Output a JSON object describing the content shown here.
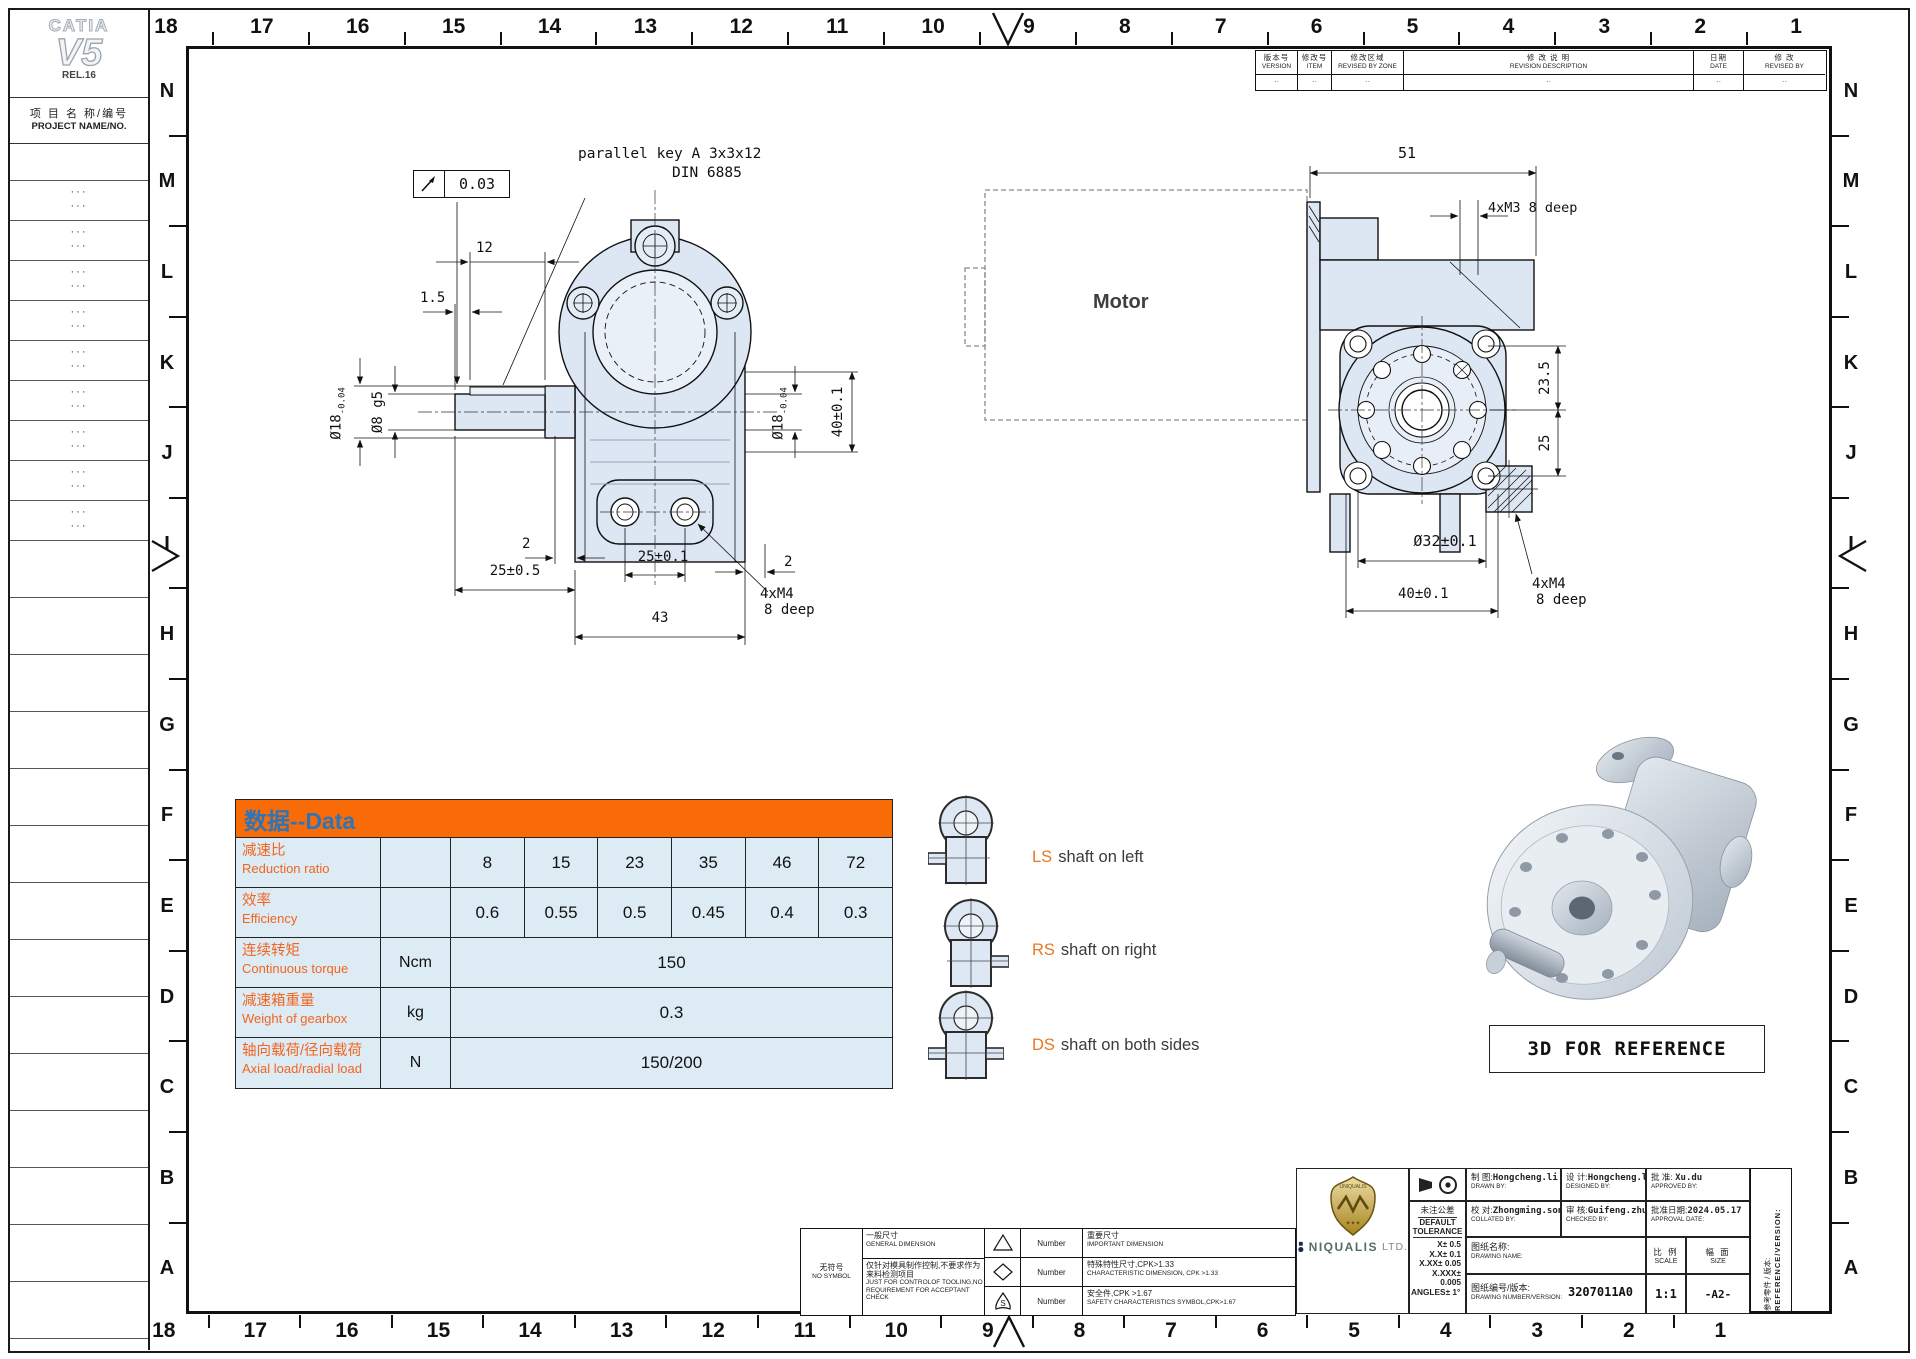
{
  "sidebar": {
    "catia": "CATIA",
    "v5": "V5",
    "rel": "REL.16",
    "project_zh": "项 目 名 称/编号",
    "project_en": "PROJECT NAME/NO.",
    "dots": "···"
  },
  "border": {
    "columns": [
      "18",
      "17",
      "16",
      "15",
      "14",
      "13",
      "12",
      "11",
      "10",
      "9",
      "8",
      "7",
      "6",
      "5",
      "4",
      "3",
      "2",
      "1"
    ],
    "rows": [
      "N",
      "M",
      "L",
      "K",
      "J",
      "I",
      "H",
      "G",
      "F",
      "E",
      "D",
      "C",
      "B",
      "A"
    ]
  },
  "revision_table": {
    "cols": [
      {
        "zh": "版本号",
        "en": "VERSION",
        "val": "··"
      },
      {
        "zh": "修改号",
        "en": "ITEM",
        "val": "··"
      },
      {
        "zh": "修改区域",
        "en": "REVISED BY ZONE",
        "val": "··"
      },
      {
        "zh": "修 改 说 明",
        "en": "REVISION DESCRIPTION",
        "val": "··"
      },
      {
        "zh": "日期",
        "en": "DATE",
        "val": "··"
      },
      {
        "zh": "修 改",
        "en": "REVISED BY",
        "val": "··"
      }
    ]
  },
  "front_view": {
    "key_note_line1": "parallel key A 3x3x12",
    "key_note_line2": "DIN 6885",
    "tol_value": "0.03",
    "dim_12": "12",
    "dim_1_5": "1.5",
    "dia18_main": "Ø18",
    "dia18_tol": "-0.04",
    "dia8": "Ø8 g5",
    "dim_40": "40±0.1",
    "dim_2a": "2",
    "dim_25_01": "25±0.1",
    "dim_25_05": "25±0.5",
    "dim_2b": "2",
    "dim_4xm4": "4xM4",
    "dim_8deep": "8 deep",
    "dim_43": "43"
  },
  "side_view": {
    "motor": "Motor",
    "dim_51": "51",
    "dim_4xm3": "4xM3  8 deep",
    "dim_23_5": "23.5",
    "dim_25": "25",
    "dia32": "Ø32±0.1",
    "dim_40": "40±0.1",
    "dim_4xm4": "4xM4",
    "dim_8deep": "8 deep"
  },
  "data_table": {
    "title": "数据--Data",
    "rows": [
      {
        "zh": "减速比",
        "en": "Reduction ratio",
        "unit": "",
        "values": [
          "8",
          "15",
          "23",
          "35",
          "46",
          "72"
        ]
      },
      {
        "zh": "效率",
        "en": "Efficiency",
        "unit": "",
        "values": [
          "0.6",
          "0.55",
          "0.5",
          "0.45",
          "0.4",
          "0.3"
        ]
      },
      {
        "zh": "连续转矩",
        "en": "Continuous torque",
        "unit": "Ncm",
        "merged": "150"
      },
      {
        "zh": "减速箱重量",
        "en": "Weight of gearbox",
        "unit": "kg",
        "merged": "0.3"
      },
      {
        "zh": "轴向载荷/径向载荷",
        "en": "Axial load/radial load",
        "unit": "N",
        "merged": "150/200"
      }
    ]
  },
  "chart_data": {
    "type": "table",
    "title": "数据--Data",
    "categories": [
      "8",
      "15",
      "23",
      "35",
      "46",
      "72"
    ],
    "series": [
      {
        "name": "Reduction ratio",
        "values": [
          8,
          15,
          23,
          35,
          46,
          72
        ]
      },
      {
        "name": "Efficiency",
        "values": [
          0.6,
          0.55,
          0.5,
          0.45,
          0.4,
          0.3
        ]
      },
      {
        "name": "Continuous torque (Ncm)",
        "values": [
          150
        ]
      },
      {
        "name": "Weight of gearbox (kg)",
        "values": [
          0.3
        ]
      },
      {
        "name": "Axial load/radial load (N)",
        "values": [
          "150/200"
        ]
      }
    ]
  },
  "shaft_legend": {
    "items": [
      {
        "code": "LS",
        "label": "shaft on left"
      },
      {
        "code": "RS",
        "label": "shaft on right"
      },
      {
        "code": "DS",
        "label": "shaft on both sides"
      }
    ]
  },
  "reference_3d": {
    "label": "3D FOR REFERENCE"
  },
  "symbols_legend": {
    "no_symbol_zh": "无符号",
    "no_symbol_en": "NO SYMBOL",
    "general_zh": "一般尺寸",
    "general_en": "GENERAL DIMENSION",
    "note_zh": "仅针对模具制作控制,不要求作为来料检测项目",
    "note_en": "JUST FOR CONTROLOF TOOLING,NO REQUIREMENT FOR ACCEPTANT CHECK",
    "number_label": "Number",
    "rows": [
      {
        "zh": "重要尺寸",
        "en": "IMPORTANT DIMENSION"
      },
      {
        "zh": "特殊特性尺寸,CPK>1.33",
        "en": "CHARACTERISTIC DIMENSION, CPK >1.33"
      },
      {
        "zh": "安全件,CPK >1.67",
        "en": "SAFETY CHARACTERISTICS SYMBOL,CPK>1.67"
      }
    ]
  },
  "title_block": {
    "company_name": "NIQUALIS",
    "company_suffix": "LTD.",
    "logo_text": "UNIQUALIS",
    "tol_zh": "未注公差",
    "tol_en1": "DEFAULT",
    "tol_en2": "TOLERANCE",
    "tol_lines": [
      "X± 0.5",
      "X.X± 0.1",
      "X.XX± 0.05",
      "X.XXX± 0.005",
      "ANGLES± 1°"
    ],
    "drawn_zh": "制 图:",
    "drawn_val": "Hongcheng.li",
    "drawn_en": "DRAWN BY:",
    "designed_zh": "设 计:",
    "designed_val": "Hongcheng.li",
    "designed_en": "DESIGNED BY:",
    "approved_zh": "批 准:",
    "approved_val": "Xu.du",
    "approved_en": "APPROVED BY:",
    "collated_zh": "校 对:",
    "collated_val": "Zhongming.song",
    "collated_en": "COLLATED BY:",
    "checked_zh": "审 核:",
    "checked_val": "Guifeng.zhuo",
    "checked_en": "CHECKED BY:",
    "date_zh": "批准日期:",
    "date_val": "2024.05.17",
    "date_en": "APPROVAL DATE:",
    "name_zh": "图纸名称:",
    "name_en": "DRAWING NAME:",
    "name_val": "",
    "number_zh": "图纸编号/版本:",
    "number_en": "DRAWING NUMBER/VERSION:",
    "number_val": "3207011A0",
    "scale_zh": "比 例",
    "scale_en": "SCALE",
    "scale_val": "1:1",
    "size_zh": "幅 面",
    "size_en": "SIZE",
    "size_val": "-A2-",
    "ref_zh": "参考零件 / 版本:",
    "ref_en": "REFERENCE/VERSION:"
  }
}
